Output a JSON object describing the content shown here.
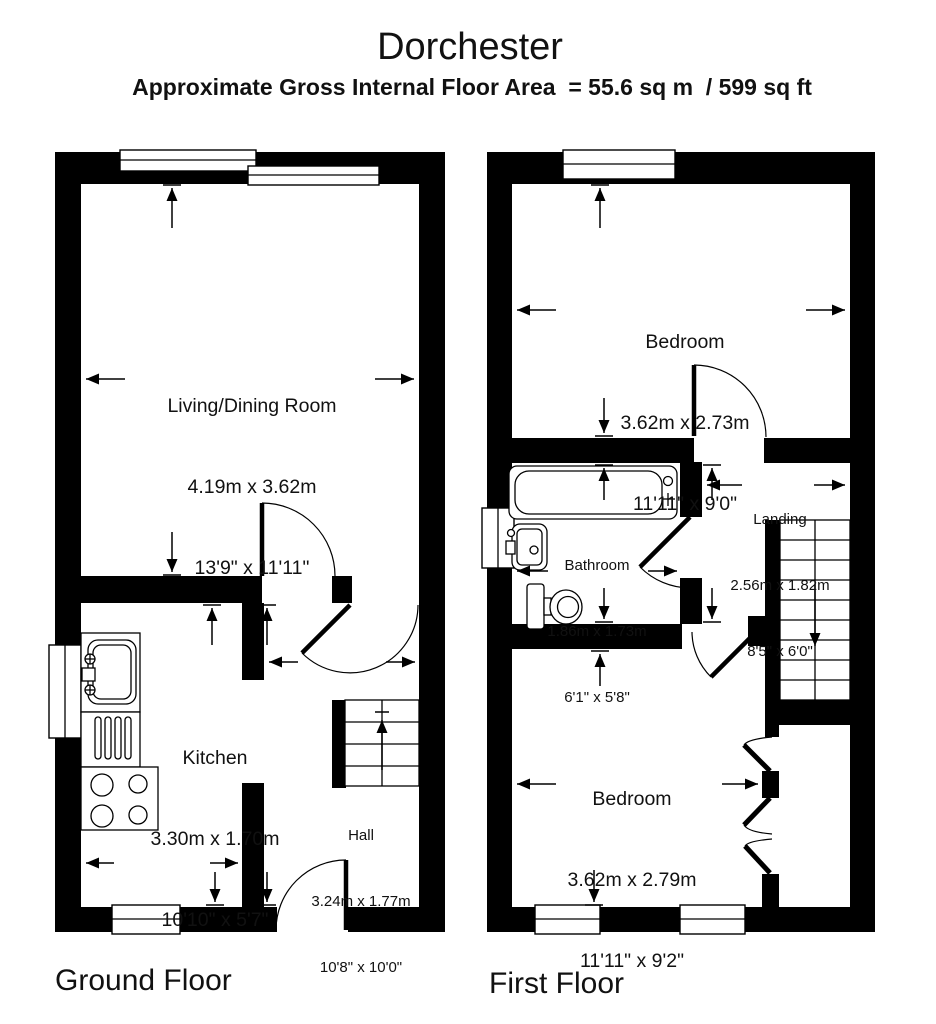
{
  "header": {
    "title": "Dorchester",
    "subtitle": "Approximate Gross Internal Floor Area  = 55.6 sq m  / 599 sq ft"
  },
  "ground_floor": {
    "label": "Ground Floor",
    "rooms": {
      "living": {
        "name": "Living/Dining Room",
        "metric": "4.19m x 3.62m",
        "imperial": "13'9\" x 11'11\""
      },
      "kitchen": {
        "name": "Kitchen",
        "metric": "3.30m x 1.70m",
        "imperial": "10'10\" x 5'7\""
      },
      "hall": {
        "name": "Hall",
        "metric": "3.24m x 1.77m",
        "imperial": "10'8\" x 10'0\""
      }
    }
  },
  "first_floor": {
    "label": "First Floor",
    "rooms": {
      "bedroom_front": {
        "name": "Bedroom",
        "metric": "3.62m x 2.73m",
        "imperial": "11'11\" x 9'0\""
      },
      "landing": {
        "name": "Landing",
        "metric": "2.56m x 1.82m",
        "imperial": "8'5\" x 6'0\""
      },
      "bathroom": {
        "name": "Bathroom",
        "metric": "1.86m x 1.73m",
        "imperial": "6'1\" x 5'8\""
      },
      "bedroom_back": {
        "name": "Bedroom",
        "metric": "3.62m x 2.79m",
        "imperial": "11'11\" x 9'2\""
      }
    }
  }
}
